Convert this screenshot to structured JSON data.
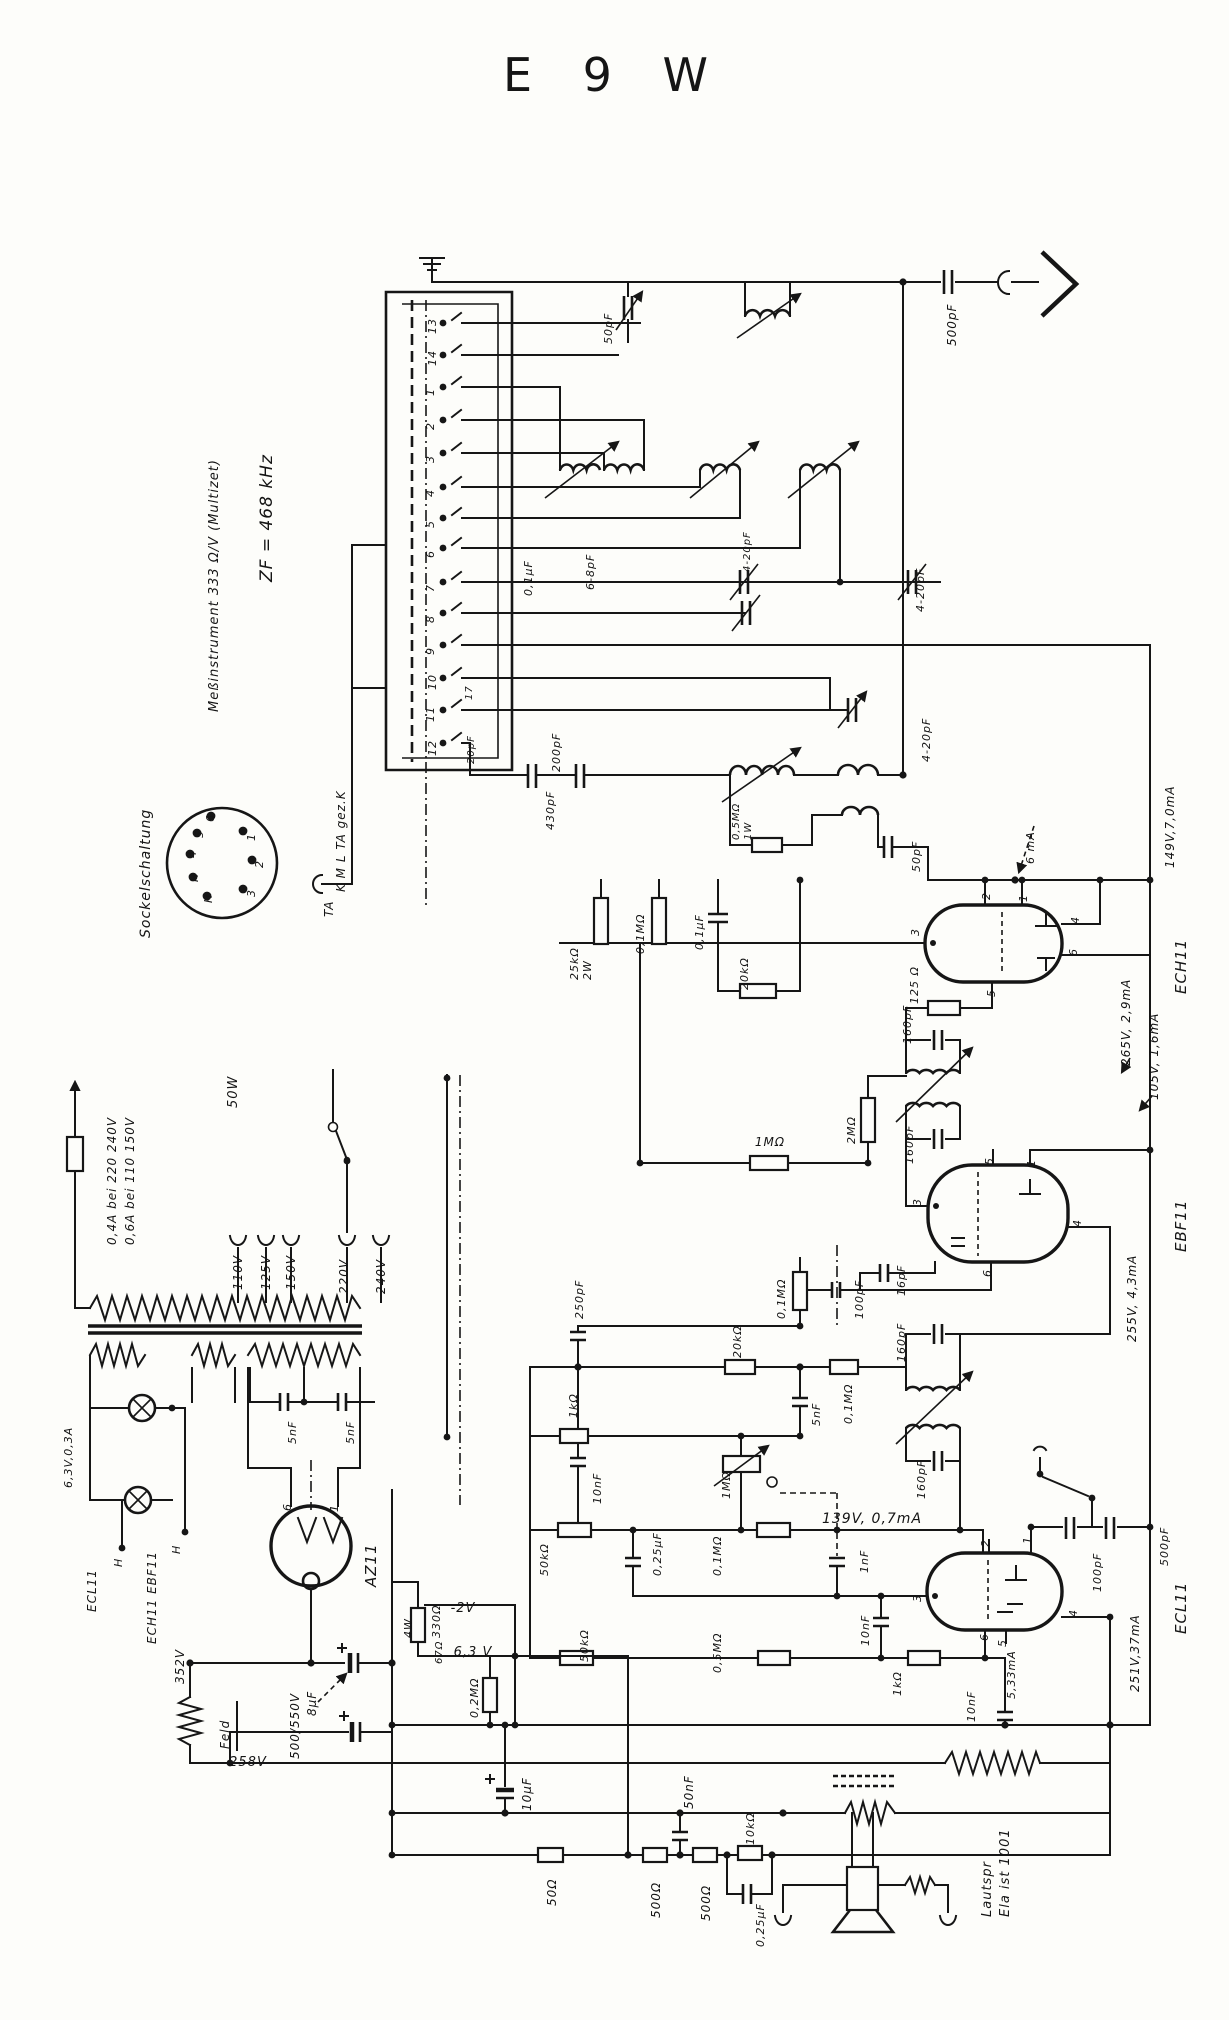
{
  "title": "E 9 W",
  "colors": {
    "ink": "#161616",
    "paper": "#fdfdfa"
  },
  "labels": {
    "notes": [
      {
        "n": "note-zf",
        "t": "ZF = 468 kHz",
        "x": 272,
        "y": 582,
        "s": 17
      },
      {
        "n": "note-meter",
        "t": "Meßinstrument 333 Ω/V (Multizet)",
        "x": 218,
        "y": 712,
        "s": 13
      },
      {
        "n": "note-sockelschaltung",
        "t": "Sockelschaltung",
        "x": 150,
        "y": 938,
        "s": 14
      }
    ],
    "socket": [
      {
        "n": "socket-pin-1",
        "t": "1",
        "x": 255,
        "y": 841
      },
      {
        "n": "socket-pin-2",
        "t": "2",
        "x": 263,
        "y": 868
      },
      {
        "n": "socket-pin-3",
        "t": "3",
        "x": 255,
        "y": 897
      },
      {
        "n": "socket-pin-6",
        "t": "6",
        "x": 214,
        "y": 822
      },
      {
        "n": "socket-pin-5",
        "t": "5",
        "x": 203,
        "y": 838
      },
      {
        "n": "socket-pin-4",
        "t": "4",
        "x": 196,
        "y": 858
      },
      {
        "n": "socket-pin-h1",
        "t": "H",
        "x": 198,
        "y": 882
      },
      {
        "n": "socket-pin-h2",
        "t": "H",
        "x": 212,
        "y": 903
      }
    ],
    "bandswitch": [
      {
        "n": "contact-13",
        "t": "13",
        "x": 436,
        "y": 334
      },
      {
        "n": "contact-14",
        "t": "14",
        "x": 436,
        "y": 366
      },
      {
        "n": "contact-1",
        "t": "1",
        "x": 434,
        "y": 396
      },
      {
        "n": "contact-2",
        "t": "2",
        "x": 434,
        "y": 430
      },
      {
        "n": "contact-3",
        "t": "3",
        "x": 434,
        "y": 463
      },
      {
        "n": "contact-4",
        "t": "4",
        "x": 434,
        "y": 497
      },
      {
        "n": "contact-5",
        "t": "5",
        "x": 434,
        "y": 528
      },
      {
        "n": "contact-6",
        "t": "6",
        "x": 434,
        "y": 558
      },
      {
        "n": "contact-7",
        "t": "7",
        "x": 434,
        "y": 592
      },
      {
        "n": "contact-8",
        "t": "8",
        "x": 434,
        "y": 623
      },
      {
        "n": "contact-9",
        "t": "9",
        "x": 434,
        "y": 655
      },
      {
        "n": "contact-10",
        "t": "10",
        "x": 436,
        "y": 690
      },
      {
        "n": "contact-11",
        "t": "11",
        "x": 434,
        "y": 722
      },
      {
        "n": "contact-12",
        "t": "12",
        "x": 436,
        "y": 756
      },
      {
        "n": "trimmer-17",
        "t": "17",
        "x": 472,
        "y": 700,
        "s": 10
      },
      {
        "n": "trimmer-20pf",
        "t": "20pF",
        "x": 474,
        "y": 764,
        "s": 10
      },
      {
        "n": "band-positions",
        "t": "K M L TA gez.K",
        "x": 345,
        "y": 892,
        "s": 12
      },
      {
        "n": "ta-terminal",
        "t": "TA",
        "x": 333,
        "y": 917,
        "s": 12
      }
    ],
    "rf": [
      {
        "n": "value-500pf-ant",
        "t": "500pF",
        "x": 956,
        "y": 346,
        "s": 12
      },
      {
        "n": "value-50pf-top",
        "t": "50pF",
        "x": 612,
        "y": 344
      },
      {
        "n": "value-01uf-rf",
        "t": "0,1μF",
        "x": 532,
        "y": 596
      },
      {
        "n": "value-6-8pf",
        "t": "6-8pF",
        "x": 594,
        "y": 590
      },
      {
        "n": "value-4-20pf-a",
        "t": "4-20pF",
        "x": 750,
        "y": 572,
        "s": 10
      },
      {
        "n": "value-4-20pf-b",
        "t": "4-20pF",
        "x": 924,
        "y": 612
      },
      {
        "n": "value-4-20pf-c",
        "t": "4-20pF",
        "x": 930,
        "y": 762
      },
      {
        "n": "value-430pf",
        "t": "430pF",
        "x": 554,
        "y": 830
      },
      {
        "n": "value-200pf",
        "t": "200pF",
        "x": 560,
        "y": 772
      },
      {
        "n": "value-05mohm-osc",
        "t": "0,5MΩ",
        "x": 739,
        "y": 840,
        "s": 10
      },
      {
        "n": "value-1w-osc",
        "t": "1W",
        "x": 751,
        "y": 840,
        "s": 10
      },
      {
        "n": "value-50pf-osc",
        "t": "50pF",
        "x": 920,
        "y": 872
      }
    ],
    "ech11": [
      {
        "n": "meas-6ma",
        "t": "6 mA",
        "x": 1034,
        "y": 864
      },
      {
        "n": "meas-149v",
        "t": "149V,7,0mA",
        "x": 1174,
        "y": 868,
        "s": 12
      },
      {
        "n": "tube-name-ech11",
        "t": "ECH11",
        "x": 1186,
        "y": 994,
        "s": 15
      },
      {
        "n": "ech-pin-2",
        "t": "2",
        "x": 990,
        "y": 900
      },
      {
        "n": "ech-pin-1",
        "t": "1",
        "x": 1027,
        "y": 902
      },
      {
        "n": "ech-pin-3",
        "t": "3",
        "x": 919,
        "y": 936
      },
      {
        "n": "ech-pin-4",
        "t": "4",
        "x": 1079,
        "y": 924
      },
      {
        "n": "ech-pin-6",
        "t": "6",
        "x": 1077,
        "y": 956
      },
      {
        "n": "ech-pin-5",
        "t": "5",
        "x": 995,
        "y": 997
      },
      {
        "n": "meas-265v",
        "t": "265V, 2,9mA",
        "x": 1130,
        "y": 1066,
        "s": 12
      },
      {
        "n": "meas-105v",
        "t": "105V, 1,6mA",
        "x": 1158,
        "y": 1100,
        "s": 12
      },
      {
        "n": "value-25kohm",
        "t": "25kΩ",
        "x": 578,
        "y": 980
      },
      {
        "n": "value-2w",
        "t": "2W",
        "x": 591,
        "y": 980
      },
      {
        "n": "value-01mohm-ech",
        "t": "0,1MΩ",
        "x": 644,
        "y": 954
      },
      {
        "n": "value-01uf-ech",
        "t": "0,1μF",
        "x": 703,
        "y": 950
      },
      {
        "n": "value-20kohm-ech",
        "t": "20kΩ",
        "x": 748,
        "y": 990
      },
      {
        "n": "value-125ohm",
        "t": "125 Ω",
        "x": 918,
        "y": 1004
      },
      {
        "n": "value-160pf-1",
        "t": "160pF",
        "x": 911,
        "y": 1044
      }
    ],
    "ebf11": [
      {
        "n": "value-2mohm",
        "t": "2MΩ",
        "x": 855,
        "y": 1144
      },
      {
        "n": "value-1mohm-avc",
        "t": "1MΩ",
        "x": 770,
        "y": 1146,
        "r": 0,
        "s": 12,
        "a": "m"
      },
      {
        "n": "value-160pf-2",
        "t": "160pF",
        "x": 913,
        "y": 1164
      },
      {
        "n": "tube-name-ebf11",
        "t": "EBF11",
        "x": 1186,
        "y": 1252,
        "s": 15
      },
      {
        "n": "ebf-pin-5",
        "t": "5",
        "x": 993,
        "y": 1165
      },
      {
        "n": "ebf-pin-1",
        "t": "1",
        "x": 1035,
        "y": 1167
      },
      {
        "n": "ebf-pin-3",
        "t": "3",
        "x": 921,
        "y": 1206
      },
      {
        "n": "ebf-pin-6",
        "t": "6",
        "x": 991,
        "y": 1277
      },
      {
        "n": "ebf-pin-4",
        "t": "4",
        "x": 1081,
        "y": 1227
      },
      {
        "n": "meas-255v",
        "t": "255V, 4,3mA",
        "x": 1136,
        "y": 1342,
        "s": 12
      },
      {
        "n": "value-16pf",
        "t": "16pF",
        "x": 905,
        "y": 1296
      },
      {
        "n": "value-100pf-det",
        "t": "100pF",
        "x": 863,
        "y": 1319
      },
      {
        "n": "value-01mohm-det",
        "t": "0,1MΩ",
        "x": 785,
        "y": 1319
      },
      {
        "n": "value-250pf",
        "t": "250pF",
        "x": 583,
        "y": 1319
      },
      {
        "n": "value-20kohm-det",
        "t": "20kΩ",
        "x": 741,
        "y": 1358
      },
      {
        "n": "value-01mohm-det2",
        "t": "0,1MΩ",
        "x": 852,
        "y": 1424
      },
      {
        "n": "value-5nf-det",
        "t": "5nF",
        "x": 820,
        "y": 1426
      },
      {
        "n": "value-160pf-3",
        "t": "160pF",
        "x": 905,
        "y": 1362
      },
      {
        "n": "value-160pf-4",
        "t": "160pF",
        "x": 925,
        "y": 1499
      },
      {
        "n": "value-1kohm-det",
        "t": "1kΩ",
        "x": 577,
        "y": 1418
      },
      {
        "n": "value-10nf-det",
        "t": "10nF",
        "x": 601,
        "y": 1504
      },
      {
        "n": "value-1mohm-pot",
        "t": "1MΩ",
        "x": 730,
        "y": 1499
      }
    ],
    "ecl11": [
      {
        "n": "meas-139v",
        "t": "139V, 0,7mA",
        "x": 872,
        "y": 1523,
        "r": 0,
        "s": 14,
        "a": "m"
      },
      {
        "n": "value-50kohm-1",
        "t": "50kΩ",
        "x": 548,
        "y": 1576
      },
      {
        "n": "value-025uf-af",
        "t": "0,25μF",
        "x": 661,
        "y": 1576
      },
      {
        "n": "value-01mohm-af",
        "t": "0,1MΩ",
        "x": 721,
        "y": 1576
      },
      {
        "n": "value-1nf",
        "t": "1nF",
        "x": 868,
        "y": 1573
      },
      {
        "n": "value-10nf-g",
        "t": "10nF",
        "x": 869,
        "y": 1646
      },
      {
        "n": "value-05mohm-g",
        "t": "0,5MΩ",
        "x": 721,
        "y": 1673
      },
      {
        "n": "value-50kohm-2",
        "t": "50kΩ",
        "x": 588,
        "y": 1662
      },
      {
        "n": "value-1kohm-k",
        "t": "1kΩ",
        "x": 901,
        "y": 1696
      },
      {
        "n": "value-100pf-tone",
        "t": "100pF",
        "x": 1101,
        "y": 1592
      },
      {
        "n": "value-500pf-tone",
        "t": "500pF",
        "x": 1168,
        "y": 1566
      },
      {
        "n": "tube-name-ecl11",
        "t": "ECL11",
        "x": 1186,
        "y": 1634,
        "s": 15
      },
      {
        "n": "ecl-pin-2",
        "t": "2",
        "x": 989,
        "y": 1547
      },
      {
        "n": "ecl-pin-1",
        "t": "1",
        "x": 1031,
        "y": 1544
      },
      {
        "n": "ecl-pin-3",
        "t": "3",
        "x": 921,
        "y": 1602
      },
      {
        "n": "ecl-pin-6",
        "t": "6",
        "x": 988,
        "y": 1641
      },
      {
        "n": "ecl-pin-4",
        "t": "4",
        "x": 1077,
        "y": 1617
      },
      {
        "n": "ecl-pin-5",
        "t": "5",
        "x": 1006,
        "y": 1647
      },
      {
        "n": "meas-251v",
        "t": "251V,37mA",
        "x": 1139,
        "y": 1692,
        "s": 12
      },
      {
        "n": "meas-533ma",
        "t": "5,33mA",
        "x": 1015,
        "y": 1699
      },
      {
        "n": "value-10nf-k",
        "t": "10nF",
        "x": 975,
        "y": 1722
      }
    ],
    "power": [
      {
        "n": "fuse-rating-1",
        "t": "0,4A bei 220 240V",
        "x": 116,
        "y": 1245,
        "s": 12
      },
      {
        "n": "fuse-rating-2",
        "t": "0,6A bei 110 150V",
        "x": 134,
        "y": 1245,
        "s": 12
      },
      {
        "n": "power-rating",
        "t": "50W",
        "x": 237,
        "y": 1108,
        "s": 13
      },
      {
        "n": "tap-110v",
        "t": "110V",
        "x": 242,
        "y": 1290,
        "s": 12
      },
      {
        "n": "tap-125v",
        "t": "125V",
        "x": 270,
        "y": 1290,
        "s": 12
      },
      {
        "n": "tap-150v",
        "t": "150V",
        "x": 295,
        "y": 1290,
        "s": 12
      },
      {
        "n": "tap-220v",
        "t": "220V",
        "x": 348,
        "y": 1294,
        "s": 12
      },
      {
        "n": "tap-240v",
        "t": "240V",
        "x": 385,
        "y": 1294,
        "s": 12
      },
      {
        "n": "lamp-rating",
        "t": "6,3V,0,3A",
        "x": 72,
        "y": 1488
      },
      {
        "n": "heater-ech-ebf",
        "t": "ECH11 EBF11",
        "x": 156,
        "y": 1644,
        "s": 12
      },
      {
        "n": "heater-ecl",
        "t": "ECL11",
        "x": 96,
        "y": 1612,
        "s": 12
      },
      {
        "n": "heater-h1",
        "t": "H",
        "x": 180,
        "y": 1554
      },
      {
        "n": "heater-h2",
        "t": "H",
        "x": 122,
        "y": 1567
      },
      {
        "n": "tube-name-az11",
        "t": "AZ11",
        "x": 376,
        "y": 1587,
        "s": 15
      },
      {
        "n": "az-pin-6",
        "t": "6",
        "x": 291,
        "y": 1511
      },
      {
        "n": "az-pin-1",
        "t": "1",
        "x": 338,
        "y": 1512
      },
      {
        "n": "value-5nf-1",
        "t": "5nF",
        "x": 296,
        "y": 1444
      },
      {
        "n": "value-5nf-2",
        "t": "5nF",
        "x": 354,
        "y": 1444
      },
      {
        "n": "meas-352v",
        "t": "352V",
        "x": 184,
        "y": 1684,
        "s": 12
      },
      {
        "n": "field-coil",
        "t": "Feld",
        "x": 229,
        "y": 1749,
        "s": 12
      },
      {
        "n": "meas-258v",
        "t": "258V",
        "x": 248,
        "y": 1766,
        "r": 0,
        "s": 13,
        "a": "m"
      },
      {
        "n": "value-8uf",
        "t": "8μF",
        "x": 316,
        "y": 1716,
        "s": 12
      },
      {
        "n": "value-500-550v",
        "t": "500/550V",
        "x": 299,
        "y": 1759,
        "s": 12
      },
      {
        "n": "value-330ohm",
        "t": "330Ω",
        "x": 440,
        "y": 1638
      },
      {
        "n": "value-4w",
        "t": "4W",
        "x": 412,
        "y": 1638
      },
      {
        "n": "meas-minus2v",
        "t": "-2V",
        "x": 463,
        "y": 1612,
        "r": 0,
        "s": 13,
        "a": "m"
      },
      {
        "n": "value-67ohm",
        "t": "67Ω",
        "x": 442,
        "y": 1664,
        "s": 10
      },
      {
        "n": "meas-63v",
        "t": "6,3 V",
        "x": 473,
        "y": 1656,
        "r": 0,
        "s": 13,
        "a": "m"
      },
      {
        "n": "value-02mohm",
        "t": "0,2MΩ",
        "x": 478,
        "y": 1718
      },
      {
        "n": "value-10uf",
        "t": "10μF",
        "x": 531,
        "y": 1811,
        "s": 12
      }
    ],
    "output": [
      {
        "n": "value-50ohm",
        "t": "50Ω",
        "x": 556,
        "y": 1906,
        "s": 12
      },
      {
        "n": "value-500ohm-1",
        "t": "500Ω",
        "x": 660,
        "y": 1918,
        "s": 12
      },
      {
        "n": "value-500ohm-2",
        "t": "500Ω",
        "x": 710,
        "y": 1921,
        "s": 12
      },
      {
        "n": "value-10kohm",
        "t": "10kΩ",
        "x": 754,
        "y": 1845
      },
      {
        "n": "value-50nf",
        "t": "50nF",
        "x": 693,
        "y": 1809,
        "s": 12
      },
      {
        "n": "value-025uf-out",
        "t": "0,25μF",
        "x": 764,
        "y": 1947
      },
      {
        "n": "speaker-note-1",
        "t": "Lautspr",
        "x": 991,
        "y": 1917,
        "s": 13
      },
      {
        "n": "speaker-note-2",
        "t": "Ela ist 1001",
        "x": 1009,
        "y": 1917,
        "s": 13
      }
    ]
  }
}
